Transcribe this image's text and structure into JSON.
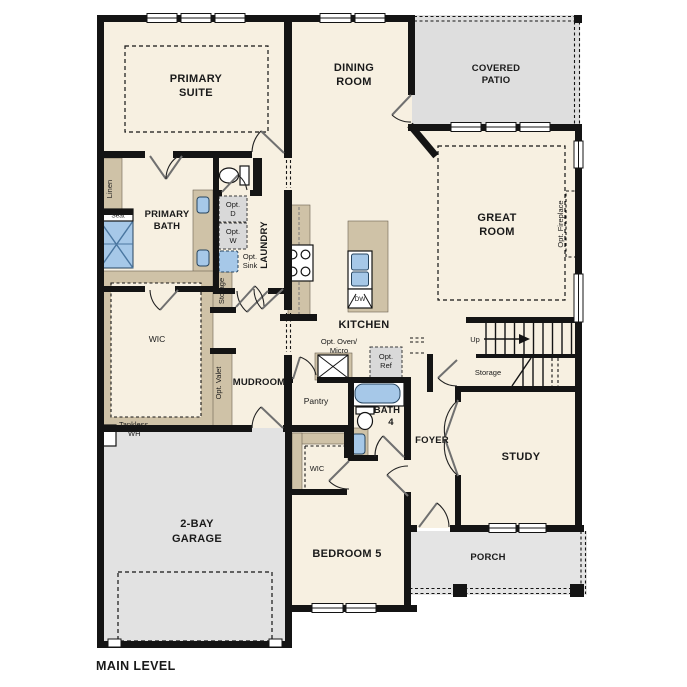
{
  "title": {
    "main_level": "MAIN LEVEL"
  },
  "colors": {
    "floor_cream": "#f7f0e1",
    "outdoor_gray": "#e0e0e0",
    "cabinet_tan": "#cfc2a7",
    "fixture_blue": "#a6c8e8",
    "wall_black": "#141414",
    "appliance_gray": "#d9d9d9"
  },
  "rooms": {
    "primary_suite": [
      "PRIMARY",
      "SUITE"
    ],
    "dining_room": [
      "DINING",
      "ROOM"
    ],
    "covered_patio": [
      "COVERED",
      "PATIO"
    ],
    "great_room": [
      "GREAT",
      "ROOM"
    ],
    "primary_bath": [
      "PRIMARY",
      "BATH"
    ],
    "laundry": "LAUNDRY",
    "wic_primary": "WIC",
    "mudroom": "MUDROOM",
    "kitchen": "KITCHEN",
    "pantry": "Pantry",
    "bath_4": [
      "BATH",
      "4"
    ],
    "foyer": "FOYER",
    "study": "STUDY",
    "garage": [
      "2-BAY",
      "GARAGE"
    ],
    "bedroom_5": "BEDROOM 5",
    "wic_bedroom5": "WIC",
    "porch": "PORCH"
  },
  "annotations": {
    "linen": "Linen",
    "seat": "Seat",
    "opt_d": [
      "Opt.",
      "D"
    ],
    "opt_w": [
      "Opt.",
      "W"
    ],
    "opt_sink": [
      "Opt.",
      "Sink"
    ],
    "storage_hall": "Storage",
    "opt_valet": "Opt. Valet",
    "opt_oven_micro": [
      "Opt. Oven/",
      "Micro"
    ],
    "opt_ref": [
      "Opt.",
      "Ref"
    ],
    "dw": "DW",
    "up": "Up",
    "storage_stairs": "Storage",
    "opt_fireplace": "Opt. Fireplace",
    "tankless_wh": [
      "Tankless",
      "WH"
    ]
  }
}
